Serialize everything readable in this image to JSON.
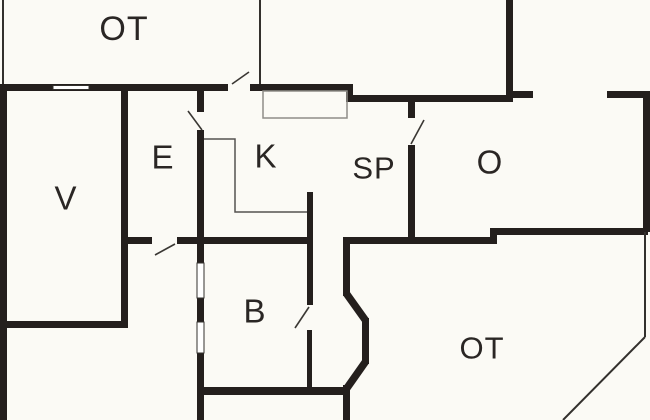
{
  "meta": {
    "type": "floor-plan",
    "canvas": {
      "width": 650,
      "height": 420
    }
  },
  "colors": {
    "background": "#fbfaf5",
    "wall": "#241f1d",
    "thin_line": "#33302d",
    "swing_line": "#3a3733",
    "counter_line": "#555250",
    "cabinet_line": "#8f8d88",
    "window_fill": "#ffffff",
    "label_text": "#2a2624"
  },
  "rooms": [
    {
      "id": "ot-top",
      "label": "OT",
      "x": 124,
      "y": 31,
      "font": 34
    },
    {
      "id": "v",
      "label": "V",
      "x": 66,
      "y": 200,
      "font": 33
    },
    {
      "id": "e",
      "label": "E",
      "x": 163,
      "y": 159,
      "font": 33
    },
    {
      "id": "k",
      "label": "K",
      "x": 266,
      "y": 158,
      "font": 33
    },
    {
      "id": "sp",
      "label": "SP",
      "x": 374,
      "y": 170,
      "font": 31
    },
    {
      "id": "o",
      "label": "O",
      "x": 490,
      "y": 164,
      "font": 33
    },
    {
      "id": "b",
      "label": "B",
      "x": 255,
      "y": 313,
      "font": 33
    },
    {
      "id": "ot-bottom",
      "label": "OT",
      "x": 482,
      "y": 350,
      "font": 31
    }
  ],
  "floorplan": {
    "walls": [
      [
        0,
        84,
        228,
        7
      ],
      [
        250,
        84,
        103,
        7
      ],
      [
        346,
        84,
        7,
        18
      ],
      [
        346,
        95,
        162,
        7
      ],
      [
        506,
        0,
        7,
        102
      ],
      [
        513,
        91,
        20,
        7
      ],
      [
        607,
        91,
        43,
        7
      ],
      [
        643,
        91,
        7,
        141
      ],
      [
        493,
        228,
        155,
        7
      ],
      [
        490,
        228,
        7,
        16
      ],
      [
        343,
        237,
        150,
        7
      ],
      [
        408,
        97,
        7,
        21
      ],
      [
        408,
        145,
        7,
        99
      ],
      [
        0,
        84,
        7,
        336
      ],
      [
        121,
        91,
        7,
        237
      ],
      [
        0,
        321,
        128,
        7
      ],
      [
        197,
        91,
        7,
        21
      ],
      [
        197,
        130,
        7,
        133
      ],
      [
        197,
        298,
        7,
        24
      ],
      [
        197,
        353,
        7,
        67
      ],
      [
        121,
        237,
        31,
        7
      ],
      [
        177,
        237,
        136,
        7
      ],
      [
        307,
        244,
        6,
        61
      ],
      [
        307,
        330,
        5,
        57
      ],
      [
        197,
        387,
        150,
        8
      ],
      [
        307,
        192,
        6,
        52
      ],
      [
        343,
        237,
        7,
        59
      ],
      [
        362,
        318,
        7,
        46
      ],
      [
        343,
        385,
        7,
        35
      ]
    ],
    "thick_diagonals": [
      [
        346,
        293,
        366,
        321
      ],
      [
        366,
        361,
        347,
        388
      ]
    ],
    "thin_lines": [
      [
        3,
        0,
        3,
        84
      ],
      [
        260,
        0,
        260,
        84
      ],
      [
        645,
        232,
        645,
        337
      ],
      [
        645,
        337,
        563,
        420
      ]
    ],
    "door_swings": [
      [
        232,
        84,
        249,
        72
      ],
      [
        188,
        111,
        202,
        130
      ],
      [
        175,
        244,
        155,
        255
      ],
      [
        411,
        144,
        424,
        120
      ],
      [
        309,
        307,
        295,
        328
      ]
    ],
    "windows": [
      [
        53,
        85.5,
        36,
        4
      ],
      [
        197,
        263,
        7,
        35
      ],
      [
        197,
        322,
        7,
        31
      ]
    ],
    "cabinet_rects": [
      [
        263,
        91,
        84,
        27
      ]
    ],
    "counter_polylines": [
      [
        [
          204,
          139
        ],
        [
          235,
          139
        ],
        [
          235,
          212
        ],
        [
          307,
          212
        ]
      ]
    ]
  }
}
